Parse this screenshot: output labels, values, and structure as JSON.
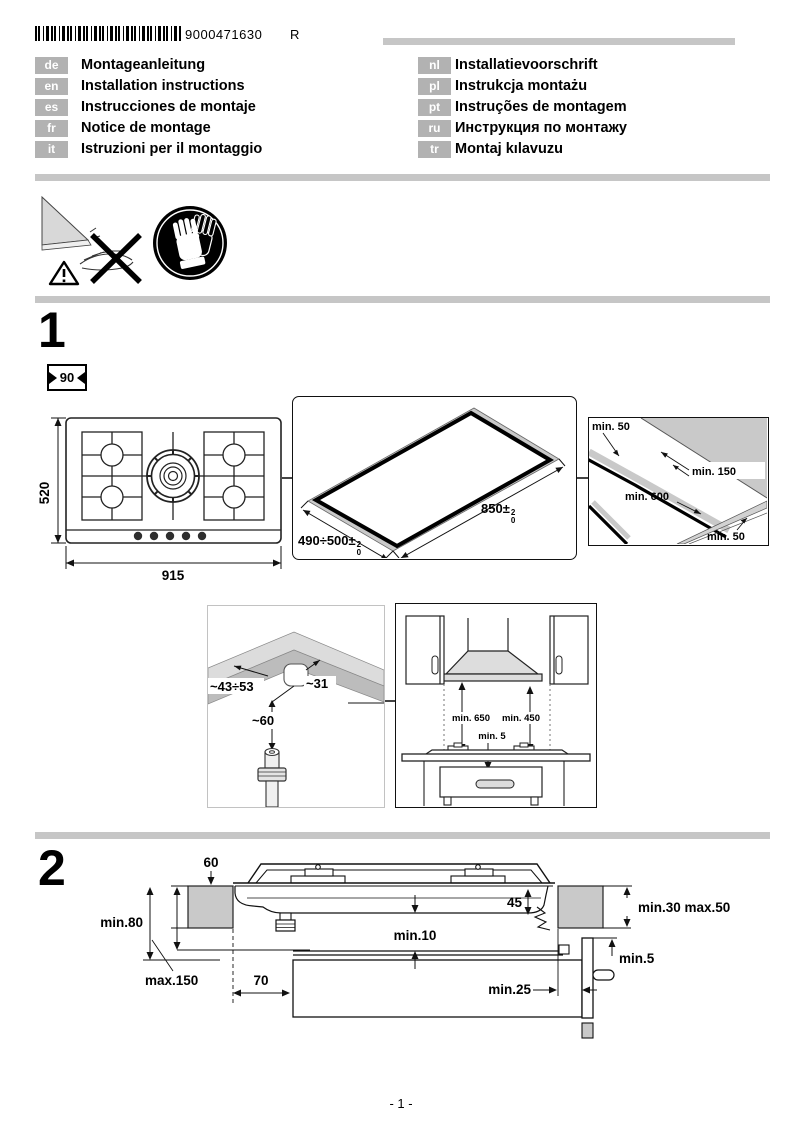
{
  "header": {
    "barcode_number": "9000471630",
    "revision": "R",
    "languages_left": [
      {
        "code": "de",
        "title": "Montageanleitung"
      },
      {
        "code": "en",
        "title": "Installation instructions"
      },
      {
        "code": "es",
        "title": "Instrucciones de montaje"
      },
      {
        "code": "fr",
        "title": "Notice de montage"
      },
      {
        "code": "it",
        "title": "Istruzioni per il montaggio"
      }
    ],
    "languages_right": [
      {
        "code": "nl",
        "title": "Installatievoorschrift"
      },
      {
        "code": "pl",
        "title": "Instrukcja montażu"
      },
      {
        "code": "pt",
        "title": "Instruções de montagem"
      },
      {
        "code": "ru",
        "title": "Инструкция по монтажу"
      },
      {
        "code": "tr",
        "title": "Montaj kılavuzu"
      }
    ]
  },
  "sections": {
    "one": "1",
    "two": "2"
  },
  "width_badge": "90",
  "hob": {
    "depth": "520",
    "width": "915"
  },
  "cutout": {
    "width": "490÷500±",
    "depth": "850±",
    "tol_top": "2",
    "tol_bottom": "0"
  },
  "clearances": {
    "top_left": "min. 50",
    "right": "min. 150",
    "center": "min. 600",
    "bottom_right": "min. 50"
  },
  "corner": {
    "left": "~43÷53",
    "right": "~31",
    "depth": "~60"
  },
  "hood": {
    "hood_height": "min. 650",
    "cabinet_height": "min. 450",
    "gap": "min. 5"
  },
  "section2": {
    "overhang": "60",
    "left_min": "min.80",
    "left_max": "max.150",
    "front": "70",
    "clearance_mid": "min.10",
    "depth": "45",
    "thickness": "min.30 max.50",
    "gap_side": "min.5",
    "gap_back": "min.25"
  },
  "footer": {
    "page": "- 1 -"
  },
  "colors": {
    "gray_fill": "#c9c9c9",
    "badge_gray": "#b2b2b2",
    "divider_gray": "#c6c6c6"
  }
}
